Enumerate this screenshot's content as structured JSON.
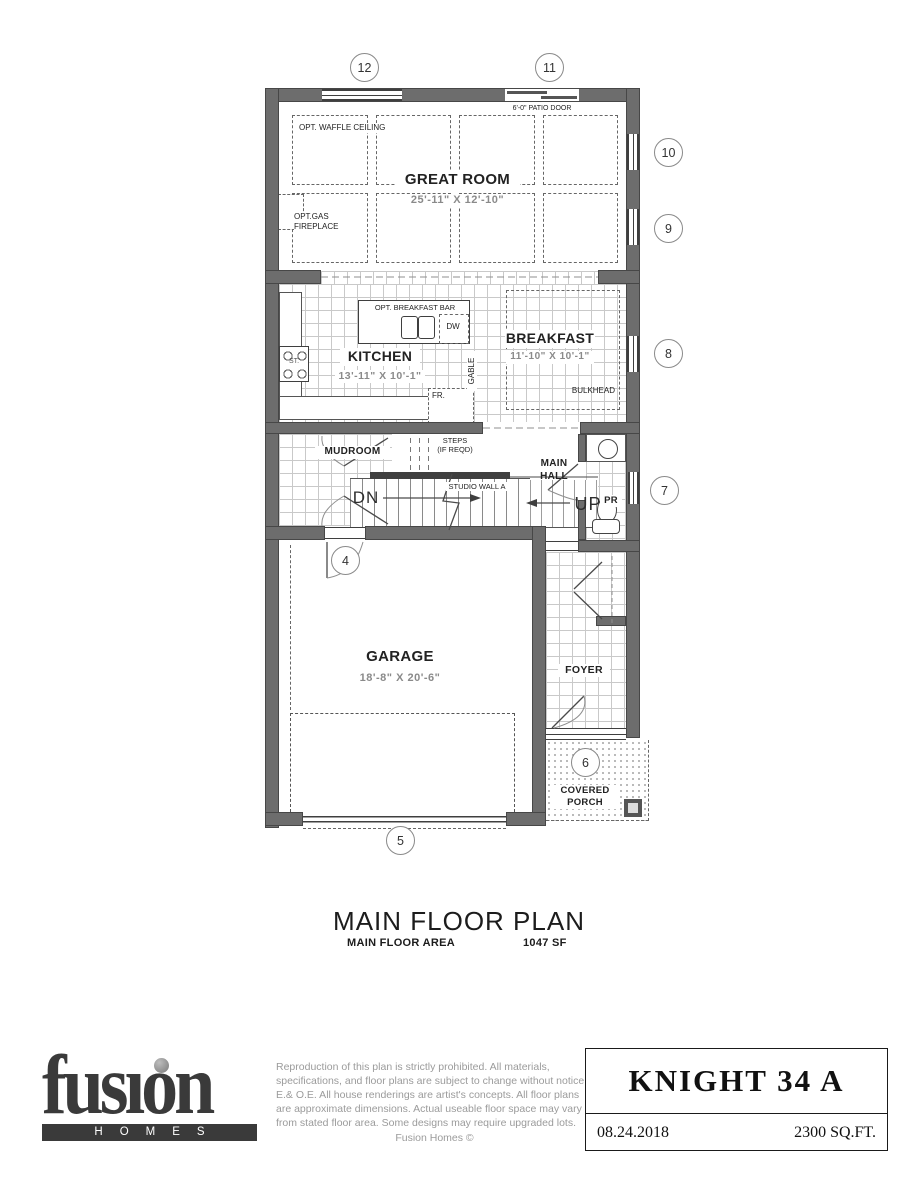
{
  "colors": {
    "wall": "#6d6d6d",
    "wall_edge": "#474747",
    "tile_line": "#c9c9c9",
    "dash": "#666666",
    "text": "#1b1b1b",
    "dim": "#8a8a8a",
    "gray_text": "#9b9b9b",
    "logo": "#3a3a3a",
    "porch_dot": "#b5b5b5"
  },
  "markers": [
    "12",
    "11",
    "10",
    "9",
    "8",
    "7",
    "4",
    "6",
    "5"
  ],
  "rooms": {
    "great_room": {
      "name": "GREAT ROOM",
      "dims": "25'-11\" X 12'-10\""
    },
    "kitchen": {
      "name": "KITCHEN",
      "dims": "13'-11\" X 10'-1\""
    },
    "breakfast": {
      "name": "BREAKFAST",
      "dims": "11'-10\" X 10'-1\""
    },
    "garage": {
      "name": "GARAGE",
      "dims": "18'-8\" X 20'-6\""
    },
    "mudroom": {
      "name": "MUDROOM"
    },
    "main_hall": {
      "name": "MAIN\nHALL"
    },
    "foyer": {
      "name": "FOYER"
    },
    "powder_room": {
      "name": "PR"
    },
    "covered_porch": {
      "name": "COVERED\nPORCH"
    }
  },
  "annotations": {
    "waffle_ceiling": "OPT. WAFFLE CEILING",
    "gas_fireplace": "OPT.GAS\nFIREPLACE",
    "patio_door": "6'-0\" PATIO DOOR",
    "breakfast_bar": "OPT. BREAKFAST BAR",
    "dishwasher": "DW",
    "fridge": "FR.",
    "stove": "ST.",
    "gable": "GABLE",
    "bulkhead": "BULKHEAD",
    "steps": "STEPS\n(IF REQD)",
    "down": "DN",
    "up": "UP",
    "studio_wall": "STUDIO WALL A"
  },
  "title_block": {
    "title": "MAIN FLOOR PLAN",
    "area_label": "MAIN FLOOR AREA",
    "area_value": "1047 SF"
  },
  "footer": {
    "logo_text": "fusion",
    "logo_sub": "HOMES",
    "disclaimer": "Reproduction of this plan is strictly prohibited.  All materials, specifications, and floor plans are subject to change without notice E.& O.E.  All house renderings are artist's concepts.  All floor plans are approximate dimensions.  Actual useable floor space may vary from stated floor area.  Some designs may require upgraded lots.",
    "copyright": "Fusion Homes ©",
    "model": "KNIGHT 34 A",
    "date": "08.24.2018",
    "sqft": "2300 SQ.FT."
  }
}
